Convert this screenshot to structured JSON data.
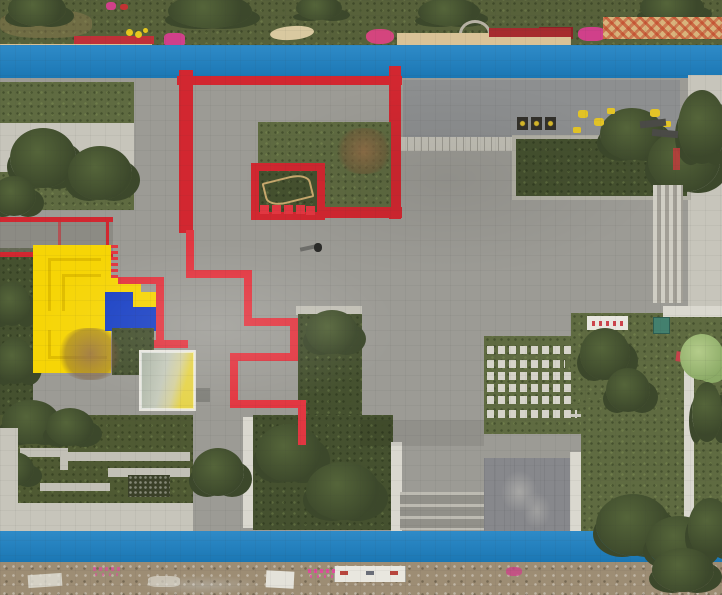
{
  "scene": {
    "type": "aerial-drone-photo",
    "subject": "top-down view of a residential plaza courtyard under construction",
    "elements": "blue running tracks at top and bottom, gray paved plaza, red maze wall with grass planter, red zig-zag ground stripe, yellow terraced play structure with blue mat, glass canopy, planters and lawns with stepping slabs, bottom dirt strip with construction debris",
    "people_visible": 1
  },
  "palette": {
    "track_blue": "#1d81c3",
    "grass_top": "#57613a",
    "lawn_green": "#5f6b41",
    "shrub_dark": "#45512f",
    "plaza_gray": "#9c9b95",
    "plaza_dark": "#8d8f90",
    "stone_light": "#c2c0b6",
    "pale_path": "#c7c5bb",
    "red_wall": "#d22730",
    "red_line": "#e23741",
    "yellow": "#f6d506",
    "blue_mat": "#1a41c4",
    "wood_tan": "#d9c297",
    "dirt_tan": "#9d8d74",
    "white_wall": "#dad8cf",
    "tree_dark": "#3c482b",
    "tree_light": "#8cab67",
    "glass_b": "#e6d44d",
    "magenta": "#d0408a",
    "teal_box": "#43806e",
    "bench_dark": "#32302a",
    "glyph_yellow": "#d8b92a",
    "red_bench": "#c03038",
    "dark_red_bench": "#a62b2e"
  },
  "features": [
    "top-greenbelt",
    "top-running-track",
    "wooden-benches",
    "playground-equipment",
    "lattice-fence",
    "red-maze-wall",
    "maze-grass-planter",
    "red-zigzag-stripe",
    "yellow-terrace-structure",
    "blue-play-mat",
    "glass-canopy",
    "red-railing-ramp",
    "left-greenbelt",
    "central-plaza",
    "tree-planters",
    "stepping-slab-lawn",
    "east-lawn",
    "white-banner-sign",
    "stairs",
    "terraced-garden",
    "bottom-running-track",
    "construction-dirt-strip",
    "pedestrian"
  ]
}
